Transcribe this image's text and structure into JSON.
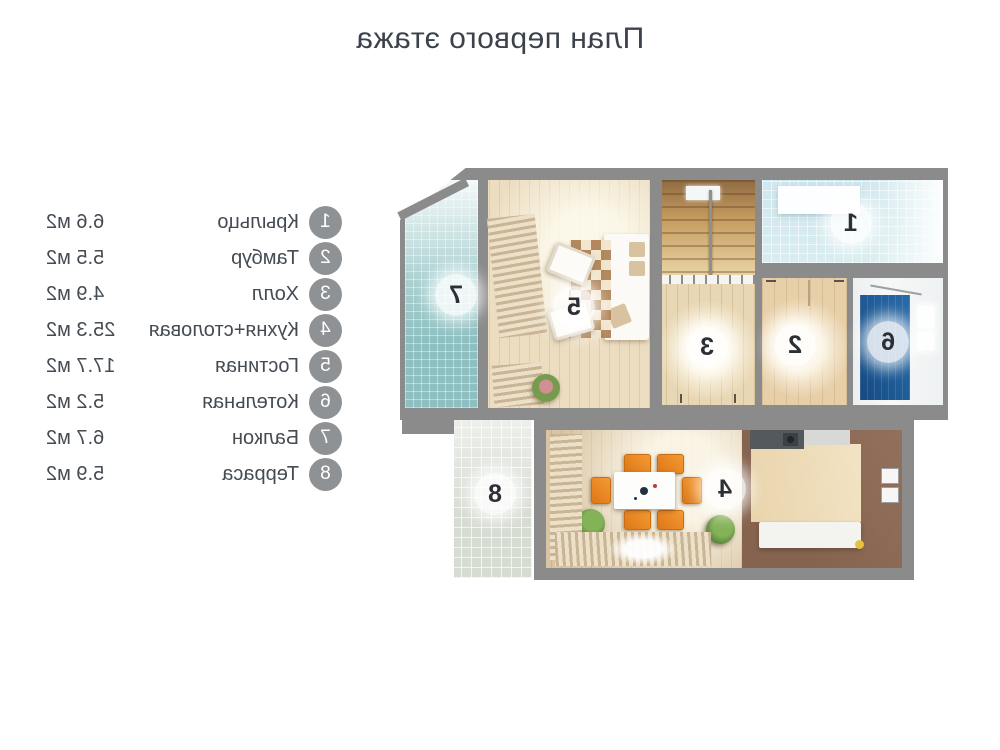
{
  "title": "План первого этажа",
  "legend": {
    "items": [
      {
        "num": "1",
        "label": "Крыльцо",
        "area": "6.6 м2"
      },
      {
        "num": "2",
        "label": "Тамбур",
        "area": "5.5 м2"
      },
      {
        "num": "3",
        "label": "Холл",
        "area": "4.9 м2"
      },
      {
        "num": "4",
        "label": "Кухня+столовая",
        "area": "25.3 м2"
      },
      {
        "num": "5",
        "label": "Гостиная",
        "area": "17.7 м2"
      },
      {
        "num": "6",
        "label": "Котельная",
        "area": "5.2 м2"
      },
      {
        "num": "7",
        "label": "Балкон",
        "area": "6.7 м2"
      },
      {
        "num": "8",
        "label": "Терраса",
        "area": "5.9 м2"
      }
    ]
  },
  "plan": {
    "rooms": [
      {
        "num": "1"
      },
      {
        "num": "2"
      },
      {
        "num": "3"
      },
      {
        "num": "4"
      },
      {
        "num": "5"
      },
      {
        "num": "6"
      },
      {
        "num": "7"
      },
      {
        "num": "8"
      }
    ]
  },
  "colors": {
    "text": "#3b424b",
    "wall_gray": "#8b8b8b",
    "legend_badge_gray": "#8f9295",
    "porch_floor_blue": "#d4e9ee",
    "tambour_floor": "#e7cfa9",
    "hall_floor": "#e8d7b4",
    "kitchen_floor_brown": "#8a6a56",
    "dining_floor_wood": "#d9c5a4",
    "living_floor_wood": "#ecddc1",
    "boiler_floor_blue": "#1e5c9b",
    "balcony_floor_teal": "#8fc0c1",
    "terrace_floor": "#d7dcd3",
    "chair_orange": "#e8821e"
  }
}
